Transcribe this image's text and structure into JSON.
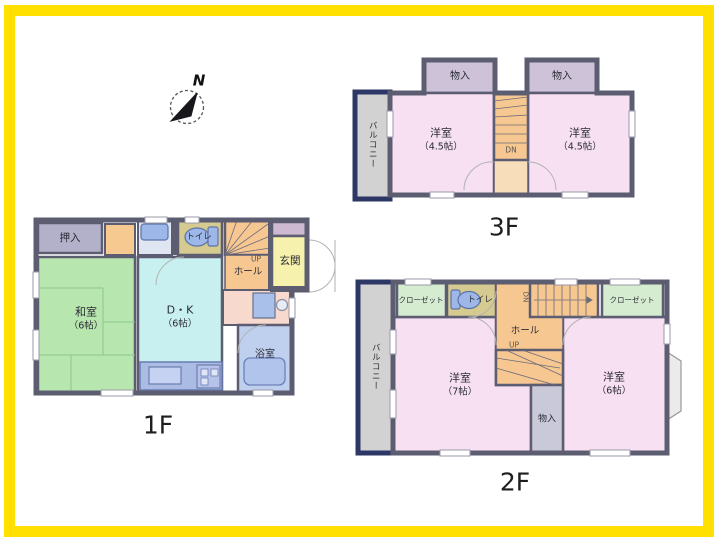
{
  "frame": {
    "border_color": "#ffe000"
  },
  "compass": {
    "north_label": "N"
  },
  "colors": {
    "wall": "#5d5d72",
    "wall_dark": "#3a3a4c",
    "balcony_wall": "#2c3766",
    "balcony_floor": "#d2d2d2",
    "tatami": "#b7e6af",
    "tatami_line": "#8cc889",
    "dk": "#c9f0f0",
    "oshiire": "#b2b1c9",
    "tokonoma": "#f5c98f",
    "senmen": "#dfe6f2",
    "toilet_room": "#d5ca90",
    "stairs": "#f6c791",
    "stairs_light": "#f8ddba",
    "genkan": "#f7f1ae",
    "shoe_cabinet": "#cdb9d2",
    "washroom": "#f8d9cd",
    "bath": "#bfd0ee",
    "fixture_blue": "#9db7e8",
    "counter": "#aabbe4",
    "youshitsu": "#f6e0f2",
    "storage_3f": "#cdc2d8",
    "closet_2f": "#d5ecd0",
    "storage_2f": "#c9c9d9",
    "bay_window": "#ebebeb"
  },
  "floor1": {
    "name": "1F",
    "rooms": {
      "oshiire": "押入",
      "washitsu": "和室",
      "washitsu_size": "（6帖）",
      "dk": "D・K",
      "dk_size": "（6帖）",
      "toilet": "トイレ",
      "hall": "ホール",
      "up": "UP",
      "genkan": "玄関",
      "bath": "浴室"
    }
  },
  "floor2": {
    "name": "2F",
    "rooms": {
      "closet_left": "クローゼット",
      "toilet": "トイレ",
      "closet_right": "クローゼット",
      "dn": "DN",
      "hall": "ホール",
      "up": "UP",
      "room_left": "洋室",
      "room_left_size": "（7帖）",
      "room_right": "洋室",
      "room_right_size": "（6帖）",
      "storage": "物入",
      "balcony": "バルコニー"
    }
  },
  "floor3": {
    "name": "3F",
    "rooms": {
      "storage_left": "物入",
      "storage_right": "物入",
      "room_left": "洋室",
      "room_left_size": "（4.5帖）",
      "room_right": "洋室",
      "room_right_size": "（4.5帖）",
      "dn": "DN",
      "balcony": "バルコニー"
    }
  }
}
